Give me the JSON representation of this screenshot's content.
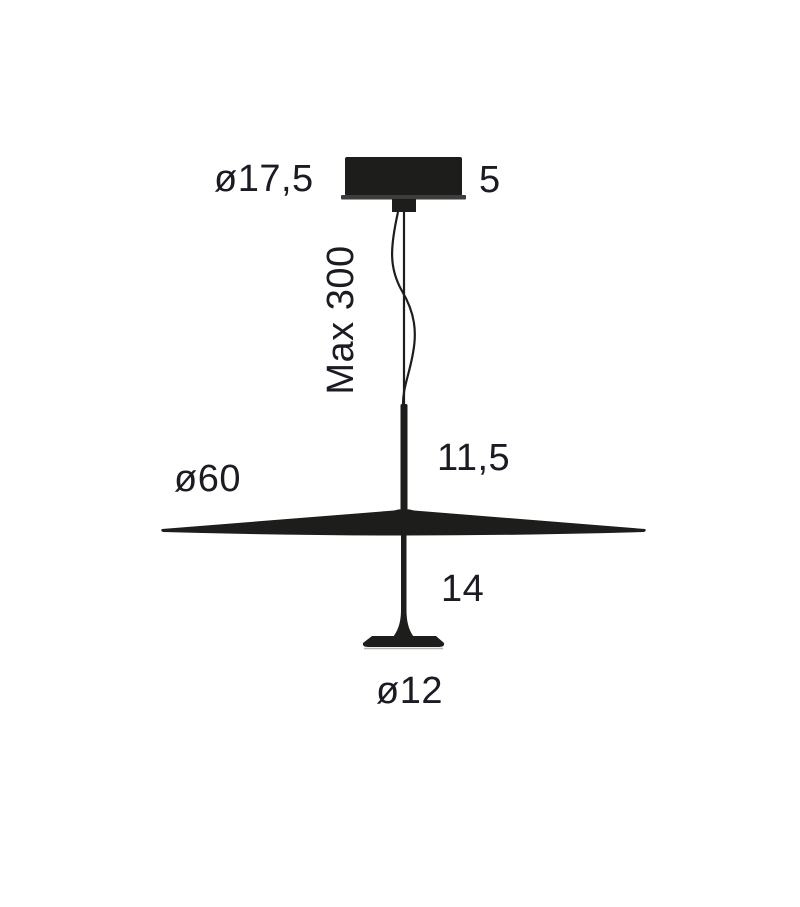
{
  "diagram": {
    "description": "Technical dimension drawing of a pendant lamp (ceiling canopy, suspension cable, flat cone shade, lower stem and foot disc)",
    "labels": {
      "canopy_diameter": "ø17,5",
      "canopy_height": "5",
      "cable_max_length": "Max 300",
      "upper_stem_length": "11,5",
      "shade_diameter": "ø60",
      "lower_stem_length": "14",
      "foot_diameter": "ø12"
    },
    "colors": {
      "ink": "#1d1d1b",
      "flange": "#3d3d3b",
      "text": "#1b1b24",
      "background": "#ffffff"
    }
  }
}
